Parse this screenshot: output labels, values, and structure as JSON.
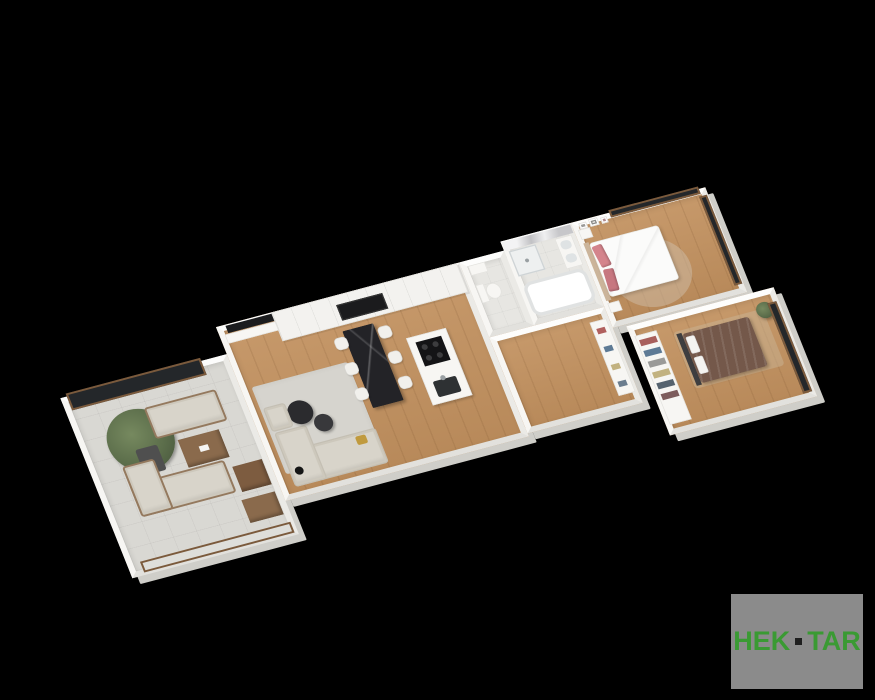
{
  "canvas": {
    "width": 875,
    "height": 700,
    "background": "#000000"
  },
  "logo": {
    "part1": "HEK",
    "separator": "·",
    "part2": "TAR",
    "panel_color": "#8b8b8b",
    "text_color": "#3a9a33",
    "dot_color": "#1f1f1f"
  },
  "scene": {
    "description": "3D isometric render of an apartment floor plan on a black background",
    "rooms": [
      {
        "id": "terrace",
        "floor": "tile"
      },
      {
        "id": "living-room-kitchen",
        "floor": "wood"
      },
      {
        "id": "wc",
        "floor": "tile"
      },
      {
        "id": "bathroom",
        "floor": "tile"
      },
      {
        "id": "hallway",
        "floor": "wood"
      },
      {
        "id": "master-bedroom",
        "floor": "wood"
      },
      {
        "id": "bedroom-2",
        "floor": "wood"
      }
    ],
    "furniture": [
      "privacy-glass-screen",
      "outdoor-sofa",
      "outdoor-corner-sofa",
      "potted-tree",
      "outdoor-coffee-table",
      "side-table",
      "ottoman",
      "glass-balustrade",
      "tv-panel",
      "tv-console",
      "console-plant",
      "area-rug",
      "sofa",
      "chaise",
      "round-coffee-tables",
      "floor-lamp",
      "accent-pillow",
      "dining-table",
      "dining-chairs",
      "kitchen-cabinet-wall",
      "built-in-ovens",
      "kitchen-island",
      "cooktop",
      "island-sink",
      "toilet",
      "washbasin",
      "shower",
      "double-vanity",
      "bathtub",
      "hall-shelf",
      "double-bed-white",
      "pink-pillows",
      "nightstands",
      "wall-frames",
      "round-rug",
      "window-wall",
      "double-bed-brown",
      "open-wardrobe",
      "clothes",
      "plant",
      "bedroom-rug"
    ]
  },
  "palette": {
    "wall": "#f6f5f2",
    "wall_shade": "#cfcec9",
    "floor_wood": "#c2915f",
    "floor_tile": "#d9d8d3",
    "glass_dark": "#24272a",
    "wood_frame": "#7b5a3c",
    "sofa_beige": "#d8d4ca",
    "rug_gray": "#d6d4ce",
    "marble_dark": "#232327",
    "pillow_pink": "#d4848c",
    "bed_brown": "#74584a",
    "plant_green": "#5c6e4b"
  }
}
